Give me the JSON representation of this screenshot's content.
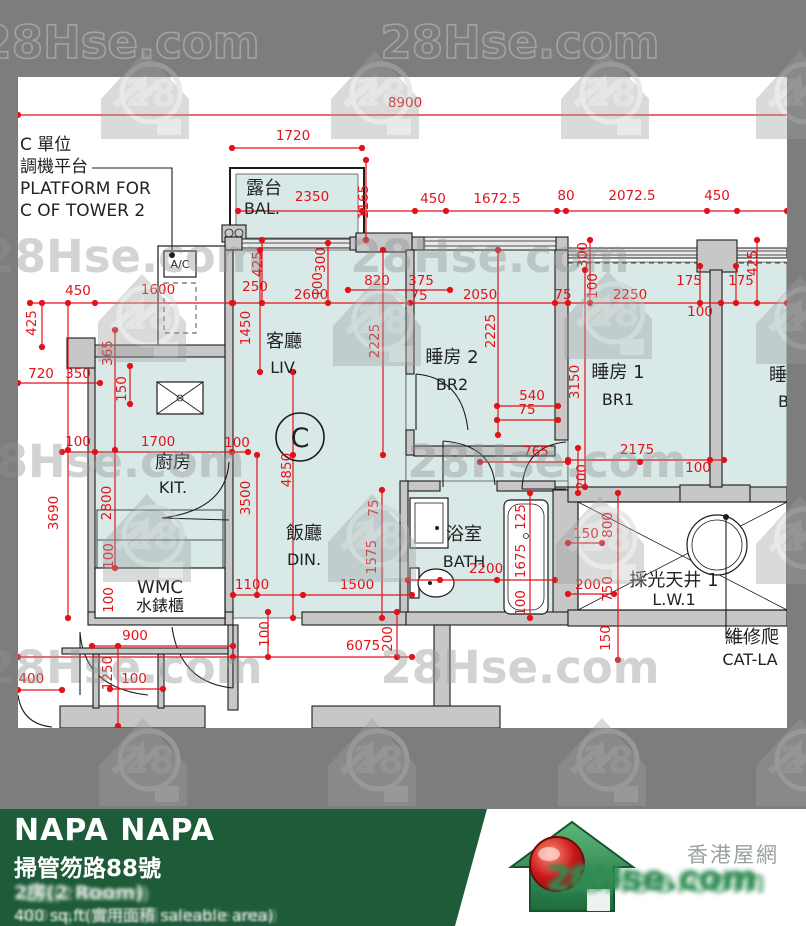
{
  "watermark": {
    "text": "28Hse.com",
    "logo": "28"
  },
  "plan": {
    "annotation_ac": {
      "lines": [
        "C 單位",
        "調機平台",
        "PLATFORM FOR",
        "C OF TOWER 2"
      ]
    },
    "ac_unit_label": "A/C",
    "unit_circle": "C",
    "rooms": [
      {
        "id": "bal",
        "zh": "露台",
        "en": "BAL.",
        "zx": 264,
        "zy": 194,
        "ex": 262,
        "ey": 214
      },
      {
        "id": "liv",
        "zh": "客廳",
        "en": "LIV.",
        "zx": 284,
        "zy": 347,
        "ex": 284,
        "ey": 373
      },
      {
        "id": "din",
        "zh": "飯廳",
        "en": "DIN.",
        "zx": 304,
        "zy": 539,
        "ex": 304,
        "ey": 565
      },
      {
        "id": "br2",
        "zh": "睡房 2",
        "en": "BR2",
        "zx": 452,
        "zy": 363,
        "ex": 452,
        "ey": 390
      },
      {
        "id": "br1",
        "zh": "睡房 1",
        "en": "BR1",
        "zx": 618,
        "zy": 378,
        "ex": 618,
        "ey": 405
      },
      {
        "id": "br3",
        "zh": "睡房",
        "en": "BR",
        "zx": 787,
        "zy": 381,
        "ex": 789,
        "ey": 407
      },
      {
        "id": "kit",
        "zh": "廚房",
        "en": "KIT.",
        "zx": 173,
        "zy": 468,
        "ex": 173,
        "ey": 493
      },
      {
        "id": "bath",
        "zh": "浴室",
        "en": "BATH",
        "zx": 464,
        "zy": 540,
        "ex": 464,
        "ey": 567
      },
      {
        "id": "lw",
        "zh": "採光天井 1",
        "en": "L.W.1",
        "zx": 674,
        "zy": 586,
        "ex": 674,
        "ey": 605
      },
      {
        "id": "wmc",
        "zh": "WMC",
        "en": "水錶櫃",
        "zx": 160,
        "zy": 593,
        "ex": 160,
        "ey": 611
      },
      {
        "id": "catl",
        "zh": "維修爬",
        "en": "CAT-LA",
        "zx": 752,
        "zy": 643,
        "ex": 750,
        "ey": 665,
        "a": "start"
      }
    ],
    "dims": [
      {
        "t": "8900",
        "x": 405,
        "y": 107
      },
      {
        "t": "1720",
        "x": 293,
        "y": 140
      },
      {
        "t": "2350",
        "x": 312,
        "y": 201
      },
      {
        "t": "1165",
        "x": 368,
        "y": 202,
        "r": 1
      },
      {
        "t": "450",
        "x": 433,
        "y": 203
      },
      {
        "t": "1672.5",
        "x": 497,
        "y": 203
      },
      {
        "t": "80",
        "x": 566,
        "y": 200
      },
      {
        "t": "2072.5",
        "x": 632,
        "y": 200
      },
      {
        "t": "450",
        "x": 717,
        "y": 200
      },
      {
        "t": "425",
        "x": 262,
        "y": 264,
        "r": 1
      },
      {
        "t": "250",
        "x": 255,
        "y": 291
      },
      {
        "t": "300",
        "x": 325,
        "y": 260,
        "r": 1
      },
      {
        "t": "100",
        "x": 322,
        "y": 285,
        "r": 1
      },
      {
        "t": "820",
        "x": 377,
        "y": 285
      },
      {
        "t": "375",
        "x": 421,
        "y": 285
      },
      {
        "t": "75",
        "x": 419,
        "y": 300
      },
      {
        "t": "2600",
        "x": 311,
        "y": 299
      },
      {
        "t": "2050",
        "x": 480,
        "y": 299
      },
      {
        "t": "75",
        "x": 563,
        "y": 299
      },
      {
        "t": "300",
        "x": 587,
        "y": 255,
        "r": 1
      },
      {
        "t": "100",
        "x": 597,
        "y": 286,
        "r": 1
      },
      {
        "t": "2250",
        "x": 630,
        "y": 299
      },
      {
        "t": "175",
        "x": 689,
        "y": 285
      },
      {
        "t": "175",
        "x": 741,
        "y": 285
      },
      {
        "t": "425",
        "x": 757,
        "y": 263,
        "r": 1
      },
      {
        "t": "100",
        "x": 700,
        "y": 316
      },
      {
        "t": "450",
        "x": 78,
        "y": 295
      },
      {
        "t": "1600",
        "x": 158,
        "y": 294
      },
      {
        "t": "425",
        "x": 36,
        "y": 323,
        "r": 1
      },
      {
        "t": "365",
        "x": 112,
        "y": 353,
        "r": 1
      },
      {
        "t": "720",
        "x": 41,
        "y": 378
      },
      {
        "t": "350",
        "x": 78,
        "y": 378
      },
      {
        "t": "150",
        "x": 126,
        "y": 389,
        "r": 1
      },
      {
        "t": "1450",
        "x": 250,
        "y": 328,
        "r": 1
      },
      {
        "t": "2225",
        "x": 379,
        "y": 341,
        "r": 1
      },
      {
        "t": "2225",
        "x": 495,
        "y": 331,
        "r": 1
      },
      {
        "t": "540",
        "x": 532,
        "y": 400
      },
      {
        "t": "75",
        "x": 527,
        "y": 414
      },
      {
        "t": "3150",
        "x": 579,
        "y": 382,
        "r": 1
      },
      {
        "t": "4850",
        "x": 291,
        "y": 470,
        "r": 1
      },
      {
        "t": "765",
        "x": 536,
        "y": 456
      },
      {
        "t": "200",
        "x": 586,
        "y": 477,
        "r": 1
      },
      {
        "t": "2175",
        "x": 637,
        "y": 454
      },
      {
        "t": "100",
        "x": 698,
        "y": 472
      },
      {
        "t": "100",
        "x": 78,
        "y": 446
      },
      {
        "t": "1700",
        "x": 158,
        "y": 446
      },
      {
        "t": "100",
        "x": 237,
        "y": 447
      },
      {
        "t": "2800",
        "x": 111,
        "y": 503,
        "r": 1
      },
      {
        "t": "3690",
        "x": 58,
        "y": 513,
        "r": 1
      },
      {
        "t": "3500",
        "x": 250,
        "y": 498,
        "r": 1
      },
      {
        "t": "100",
        "x": 113,
        "y": 556,
        "r": 1
      },
      {
        "t": "100",
        "x": 113,
        "y": 600,
        "r": 1
      },
      {
        "t": "1100",
        "x": 252,
        "y": 589
      },
      {
        "t": "1500",
        "x": 357,
        "y": 589
      },
      {
        "t": "75",
        "x": 378,
        "y": 508,
        "r": 1
      },
      {
        "t": "1575",
        "x": 376,
        "y": 557,
        "r": 1
      },
      {
        "t": "2200",
        "x": 486,
        "y": 573
      },
      {
        "t": "125",
        "x": 525,
        "y": 517,
        "r": 1
      },
      {
        "t": "1675",
        "x": 525,
        "y": 561,
        "r": 1
      },
      {
        "t": "100",
        "x": 525,
        "y": 603,
        "r": 1
      },
      {
        "t": "150",
        "x": 586,
        "y": 538
      },
      {
        "t": "800",
        "x": 612,
        "y": 525,
        "r": 1
      },
      {
        "t": "200",
        "x": 588,
        "y": 589
      },
      {
        "t": "750",
        "x": 612,
        "y": 589,
        "r": 1
      },
      {
        "t": "150",
        "x": 610,
        "y": 638,
        "r": 1
      },
      {
        "t": "100",
        "x": 269,
        "y": 634,
        "r": 1
      },
      {
        "t": "6075",
        "x": 363,
        "y": 650
      },
      {
        "t": "200",
        "x": 392,
        "y": 639,
        "r": 1
      },
      {
        "t": "900",
        "x": 135,
        "y": 640
      },
      {
        "t": "1250",
        "x": 112,
        "y": 673,
        "r": 1
      },
      {
        "t": "100",
        "x": 134,
        "y": 683
      },
      {
        "t": "1400",
        "x": 27,
        "y": 683
      }
    ]
  },
  "footer": {
    "title": "NAPA NAPA",
    "address": "掃管笏路88號",
    "line3": "2房(2 Room)",
    "line4": "400 sq.ft(實用面積 saleable area)",
    "brand_zh": "香港屋網",
    "brand": "28Hse.com"
  }
}
